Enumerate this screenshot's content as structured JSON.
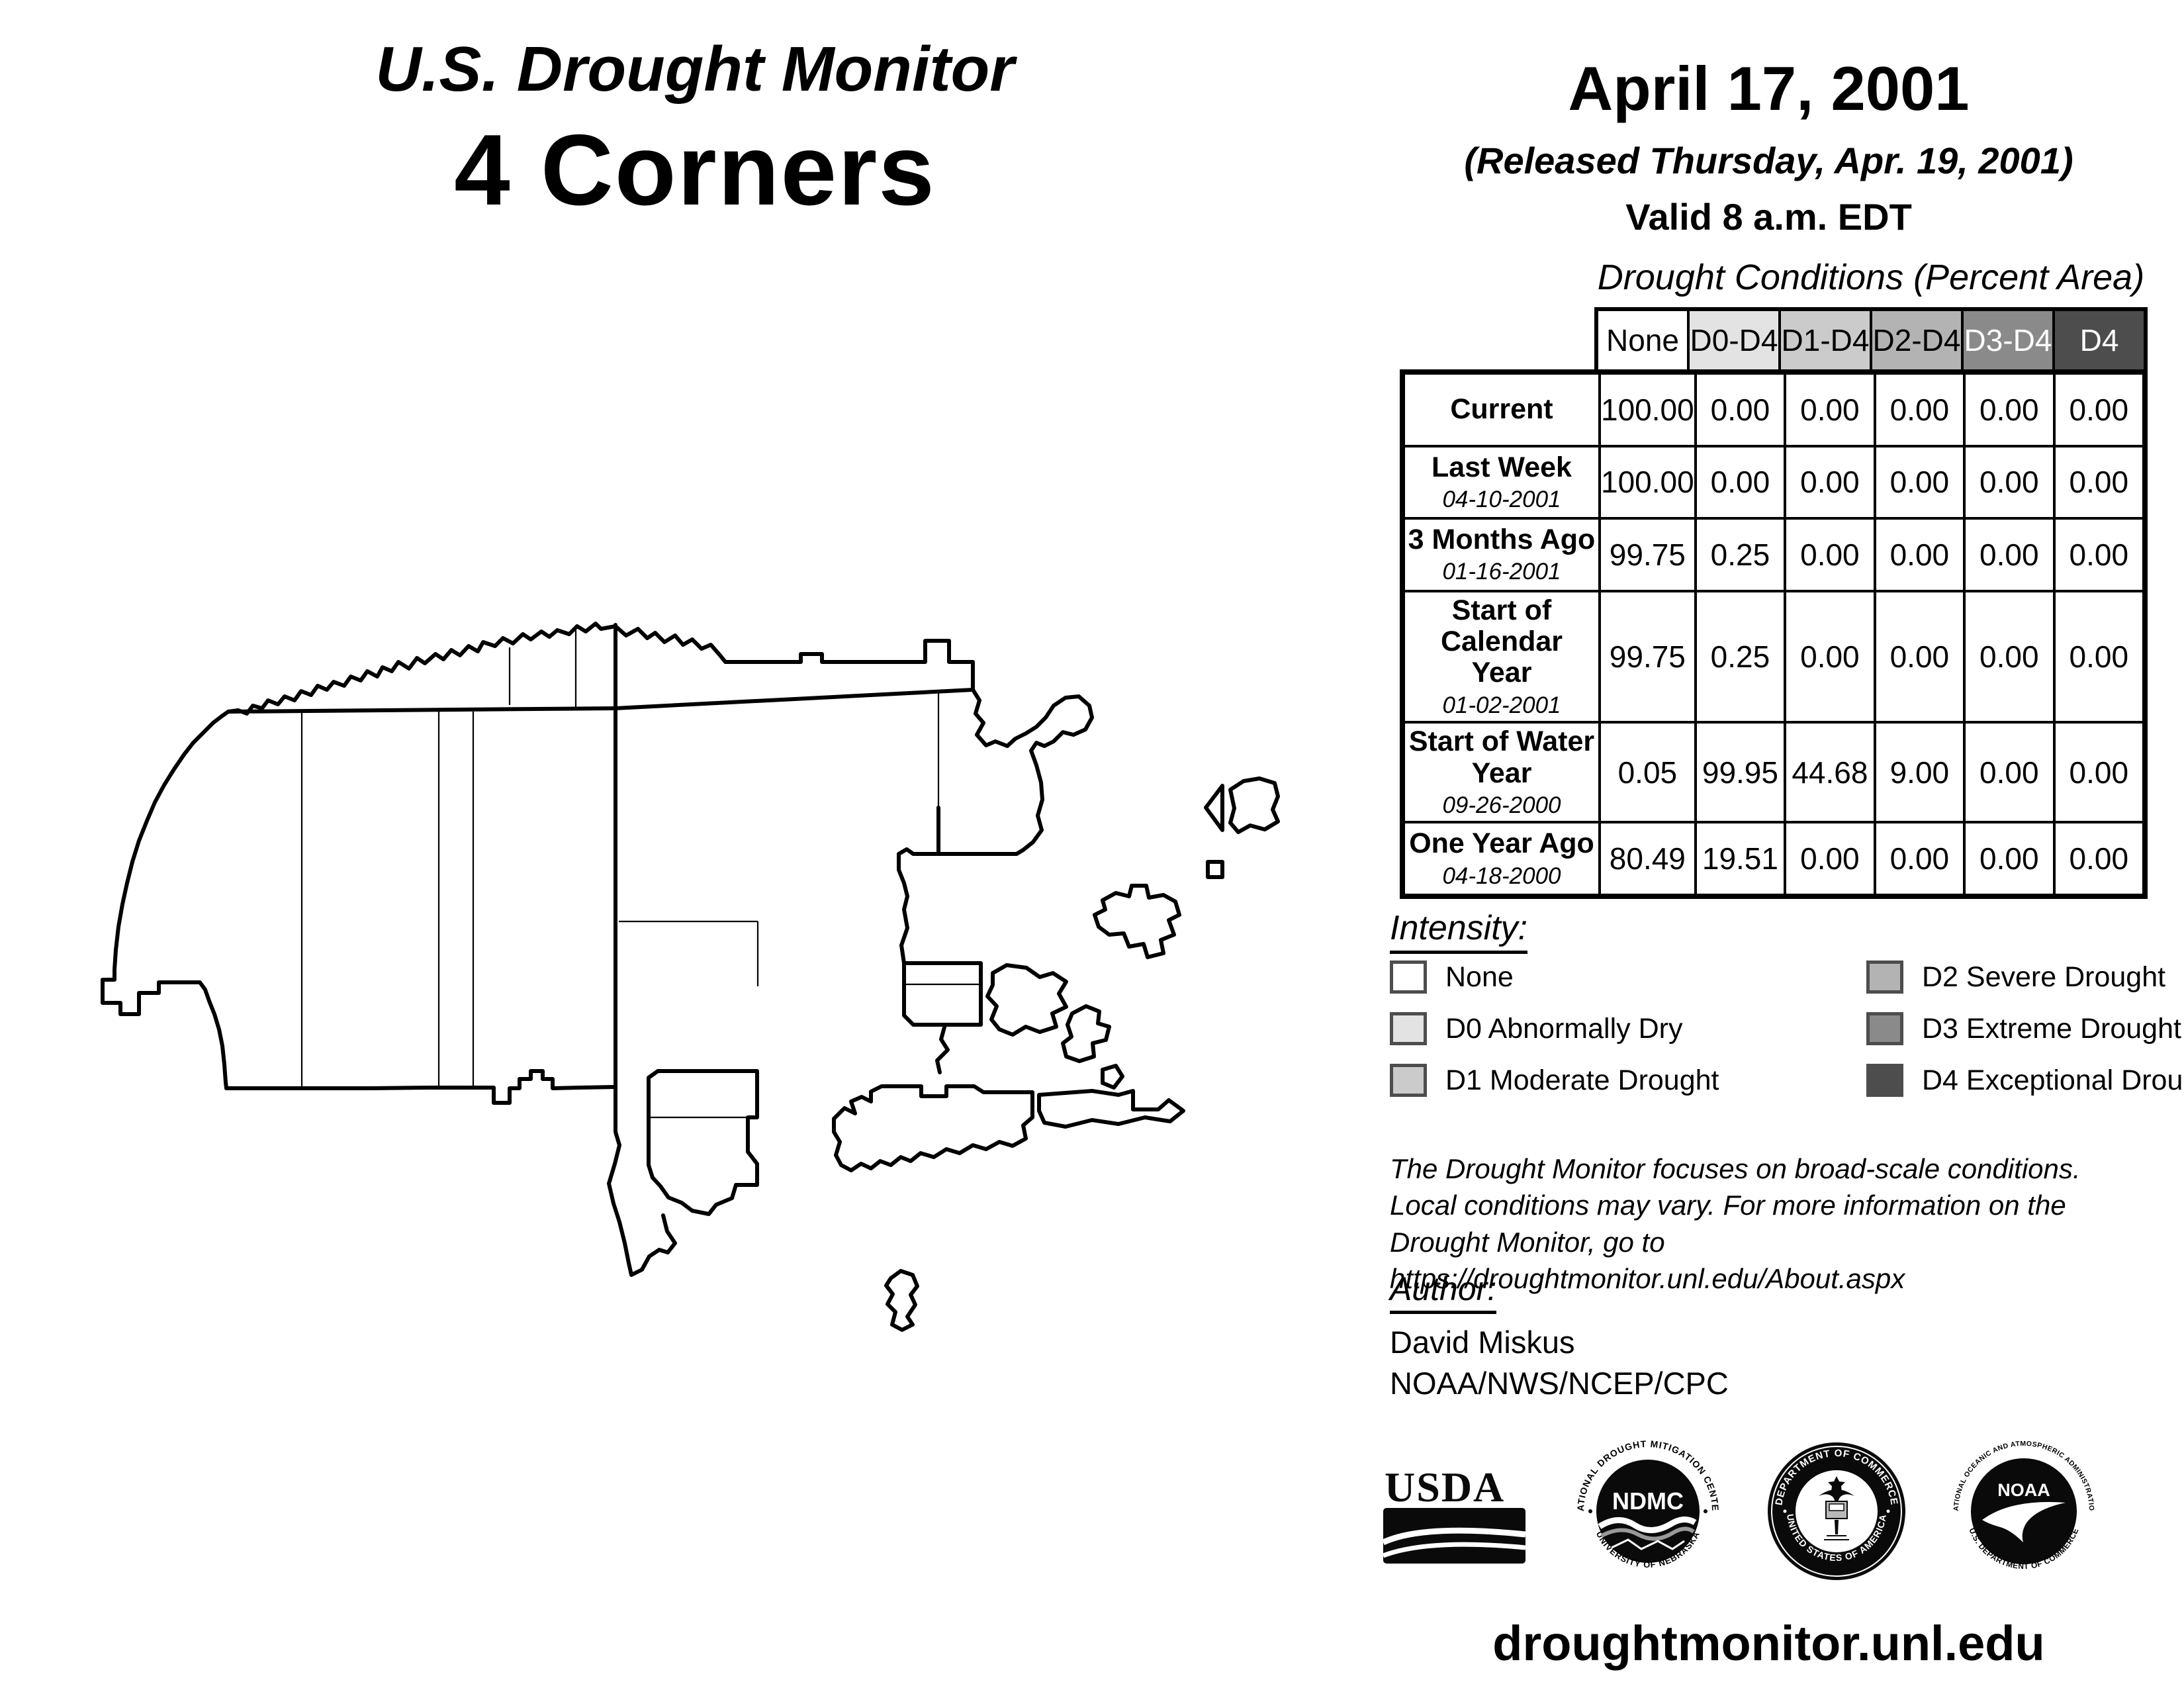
{
  "header": {
    "title_line1": "U.S. Drought Monitor",
    "title_line2": "4 Corners",
    "date": "April 17, 2001",
    "released": "(Released Thursday, Apr. 19, 2001)",
    "valid": "Valid 8 a.m. EDT"
  },
  "table": {
    "title": "Drought Conditions (Percent Area)",
    "columns": [
      {
        "label": "None",
        "bg": "#ffffff",
        "fg": "#000000"
      },
      {
        "label": "D0-D4",
        "bg": "#e3e3e3",
        "fg": "#000000"
      },
      {
        "label": "D1-D4",
        "bg": "#cbcbcb",
        "fg": "#000000"
      },
      {
        "label": "D2-D4",
        "bg": "#b3b3b3",
        "fg": "#000000"
      },
      {
        "label": "D3-D4",
        "bg": "#8a8a8a",
        "fg": "#ffffff"
      },
      {
        "label": "D4",
        "bg": "#4d4d4d",
        "fg": "#ffffff"
      }
    ],
    "rows": [
      {
        "label": "Current",
        "date": "",
        "values": [
          "100.00",
          "0.00",
          "0.00",
          "0.00",
          "0.00",
          "0.00"
        ]
      },
      {
        "label": "Last Week",
        "date": "04-10-2001",
        "values": [
          "100.00",
          "0.00",
          "0.00",
          "0.00",
          "0.00",
          "0.00"
        ]
      },
      {
        "label": "3 Months Ago",
        "date": "01-16-2001",
        "values": [
          "99.75",
          "0.25",
          "0.00",
          "0.00",
          "0.00",
          "0.00"
        ]
      },
      {
        "label": "Start of Calendar Year",
        "date": "01-02-2001",
        "values": [
          "99.75",
          "0.25",
          "0.00",
          "0.00",
          "0.00",
          "0.00"
        ]
      },
      {
        "label": "Start of Water Year",
        "date": "09-26-2000",
        "values": [
          "0.05",
          "99.95",
          "44.68",
          "9.00",
          "0.00",
          "0.00"
        ]
      },
      {
        "label": "One Year Ago",
        "date": "04-18-2000",
        "values": [
          "80.49",
          "19.51",
          "0.00",
          "0.00",
          "0.00",
          "0.00"
        ]
      }
    ]
  },
  "legend": {
    "title": "Intensity:",
    "swatch_border": "#4d4d4d",
    "items": [
      {
        "label": "None",
        "color": "#ffffff"
      },
      {
        "label": "D0 Abnormally Dry",
        "color": "#e3e3e3"
      },
      {
        "label": "D1 Moderate Drought",
        "color": "#cbcbcb"
      },
      {
        "label": "D2 Severe Drought",
        "color": "#b3b3b3"
      },
      {
        "label": "D3 Extreme Drought",
        "color": "#8a8a8a"
      },
      {
        "label": "D4 Exceptional Drought",
        "color": "#4d4d4d"
      }
    ]
  },
  "disclaimer": {
    "lines": [
      "The Drought Monitor focuses on broad-scale conditions.",
      "Local conditions may vary. For more information on the",
      "Drought Monitor, go to https://droughtmonitor.unl.edu/About.aspx"
    ]
  },
  "author": {
    "title": "Author:",
    "name": "David Miskus",
    "org": "NOAA/NWS/NCEP/CPC"
  },
  "footer": {
    "url": "droughtmonitor.unl.edu"
  },
  "logos": {
    "usda": {
      "text": "USDA"
    },
    "ndmc": {
      "center": "NDMC",
      "top": "NATIONAL DROUGHT MITIGATION CENTER",
      "bottom": "UNIVERSITY OF NEBRASKA"
    },
    "commerce": {
      "top": "DEPARTMENT OF COMMERCE",
      "bottom": "UNITED STATES OF AMERICA"
    },
    "noaa": {
      "center": "NOAA",
      "top": "NATIONAL OCEANIC AND ATMOSPHERIC ADMINISTRATION",
      "bottom": "U.S. DEPARTMENT OF COMMERCE"
    }
  }
}
